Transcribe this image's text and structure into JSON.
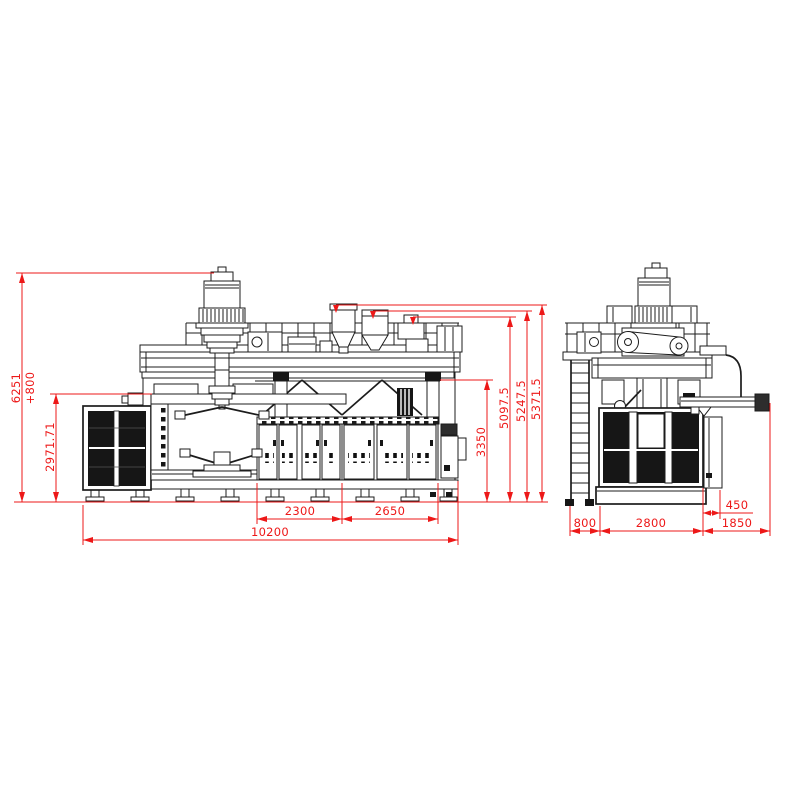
{
  "colors": {
    "background": "#ffffff",
    "line": "#1c1c1c",
    "dimension": "#ed1818"
  },
  "front_view": {
    "overall_height": "6251",
    "overall_height_extra": "+800",
    "clamp_unit_height": "2971.71",
    "subframe_height": "3350",
    "ref_height_small": "5097.5",
    "ref_height_mid": "5247.5",
    "ref_height_tall": "5371.5",
    "bay_width_1": "2300",
    "bay_width_2": "2650",
    "overall_length": "10200"
  },
  "side_view": {
    "ladder_depth": "800",
    "machine_depth": "2800",
    "discharge_depth": "1850",
    "panel_offset": "450"
  }
}
